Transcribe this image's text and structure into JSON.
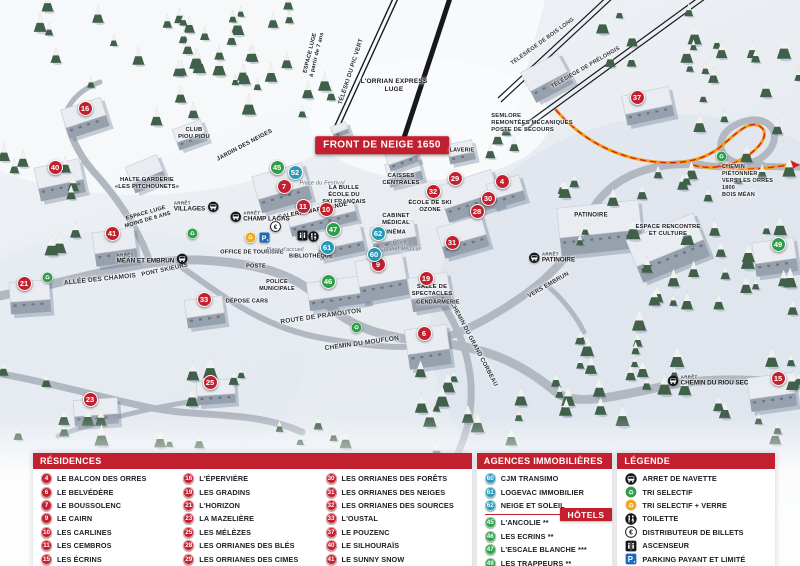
{
  "map": {
    "banner": "FRONT DE NEIGE 1650",
    "colors": {
      "residence": "#c2202e",
      "agency": "#2898b4",
      "hotel": "#2f9e49",
      "accent_red": "#c2202e",
      "path_orange": "#f39c12",
      "parking_blue": "#1a6ab5"
    },
    "markers": [
      {
        "n": "16",
        "type": "residence",
        "x": 85,
        "y": 108
      },
      {
        "n": "40",
        "type": "residence",
        "x": 55,
        "y": 167
      },
      {
        "n": "41",
        "type": "residence",
        "x": 112,
        "y": 233
      },
      {
        "n": "21",
        "type": "residence",
        "x": 24,
        "y": 283
      },
      {
        "n": "33",
        "type": "residence",
        "x": 204,
        "y": 299
      },
      {
        "n": "23",
        "type": "residence",
        "x": 90,
        "y": 399
      },
      {
        "n": "25",
        "type": "residence",
        "x": 210,
        "y": 382
      },
      {
        "n": "7",
        "type": "residence",
        "x": 284,
        "y": 186
      },
      {
        "n": "11",
        "type": "residence",
        "x": 303,
        "y": 206
      },
      {
        "n": "10",
        "type": "residence",
        "x": 326,
        "y": 209
      },
      {
        "n": "9",
        "type": "residence",
        "x": 378,
        "y": 264
      },
      {
        "n": "19",
        "type": "residence",
        "x": 426,
        "y": 278
      },
      {
        "n": "6",
        "type": "residence",
        "x": 424,
        "y": 333
      },
      {
        "n": "29",
        "type": "residence",
        "x": 455,
        "y": 178
      },
      {
        "n": "32",
        "type": "residence",
        "x": 433,
        "y": 191
      },
      {
        "n": "30",
        "type": "residence",
        "x": 488,
        "y": 198
      },
      {
        "n": "28",
        "type": "residence",
        "x": 477,
        "y": 211
      },
      {
        "n": "31",
        "type": "residence",
        "x": 452,
        "y": 242
      },
      {
        "n": "37",
        "type": "residence",
        "x": 637,
        "y": 97
      },
      {
        "n": "15",
        "type": "residence",
        "x": 778,
        "y": 378
      },
      {
        "n": "4",
        "type": "residence",
        "x": 502,
        "y": 181
      },
      {
        "n": "52",
        "type": "agency",
        "x": 295,
        "y": 172
      },
      {
        "n": "60",
        "type": "agency",
        "x": 374,
        "y": 254
      },
      {
        "n": "61",
        "type": "agency",
        "x": 327,
        "y": 247
      },
      {
        "n": "62",
        "type": "agency",
        "x": 378,
        "y": 233
      },
      {
        "n": "45",
        "type": "hotel",
        "x": 277,
        "y": 167
      },
      {
        "n": "47",
        "type": "hotel",
        "x": 333,
        "y": 229
      },
      {
        "n": "46",
        "type": "hotel",
        "x": 328,
        "y": 281
      },
      {
        "n": "49",
        "type": "hotel",
        "x": 778,
        "y": 244
      }
    ],
    "icons": [
      {
        "icon": "recycle-green",
        "x": 192,
        "y": 233
      },
      {
        "icon": "recycle-green",
        "x": 47,
        "y": 277
      },
      {
        "icon": "recycle-green",
        "x": 356,
        "y": 327
      },
      {
        "icon": "recycle-green",
        "x": 721,
        "y": 156
      },
      {
        "icon": "recycle-yellow",
        "x": 250,
        "y": 237
      },
      {
        "icon": "parking",
        "x": 264,
        "y": 237
      },
      {
        "icon": "euro",
        "x": 275,
        "y": 226
      },
      {
        "icon": "elevator",
        "x": 302,
        "y": 235
      },
      {
        "icon": "toilet",
        "x": 313,
        "y": 236
      }
    ],
    "stops": [
      {
        "prefix": "ARRÊT",
        "name": "VILLAGES",
        "x": 196,
        "y": 207,
        "side": "right"
      },
      {
        "prefix": "ARRÊT",
        "name": "CHAMP LACAS",
        "x": 260,
        "y": 217,
        "side": "left"
      },
      {
        "prefix": "ARRÊT",
        "name": "MÉAN ET EMBRUN",
        "x": 152,
        "y": 259,
        "side": "right"
      },
      {
        "prefix": "ARRÊT",
        "name": "PATINOIRE",
        "x": 552,
        "y": 258,
        "side": "left"
      },
      {
        "prefix": "ARRÊT",
        "name": "CHEMIN DU RIOU SEC",
        "x": 708,
        "y": 381,
        "side": "left"
      }
    ],
    "labels": [
      {
        "text": "FRONT DE NEIGE 1650",
        "x": 382,
        "y": 145,
        "style": "banner",
        "size": 10
      },
      {
        "text": "L'ORRIAN EXPRESS\nLUGE",
        "x": 394,
        "y": 86,
        "style": "poi",
        "size": 6.5
      },
      {
        "text": "TÉLÉSKI DU PIC VERT",
        "x": 352,
        "y": 72,
        "rot": -72,
        "style": "road",
        "size": 6
      },
      {
        "text": "ESPACE LUGE\nà partir de 7 ans",
        "x": 314,
        "y": 54,
        "rot": -76,
        "style": "poi",
        "size": 5.5
      },
      {
        "text": "TÉLÉSIÈGE DE BOIS LONG",
        "x": 543,
        "y": 42,
        "rot": -36,
        "style": "road",
        "size": 5.5
      },
      {
        "text": "TÉLÉSIÈGE DE PRÉLONGIS",
        "x": 586,
        "y": 68,
        "rot": -30,
        "style": "road",
        "size": 5.5
      },
      {
        "text": "SEMLORE\nREMONTÉES MÉCANIQUES\nPOSTE DE SECOURS",
        "x": 532,
        "y": 124,
        "style": "poi-left",
        "size": 5.8
      },
      {
        "text": "CLUB\nPIOU PIOU",
        "x": 194,
        "y": 134,
        "style": "poi",
        "size": 5.8
      },
      {
        "text": "JARDIN DES NEIGES",
        "x": 245,
        "y": 146,
        "rot": -28,
        "style": "poi",
        "size": 5.8
      },
      {
        "text": "HALTE GARDERIE\n«LES PITCHOUNETS»",
        "x": 147,
        "y": 184,
        "style": "poi",
        "size": 5.8
      },
      {
        "text": "ESPACE LUGE\nMOINS DE 6 ANS",
        "x": 147,
        "y": 217,
        "rot": -16,
        "style": "poi",
        "size": 5.5
      },
      {
        "text": "PONT SKIEURS",
        "x": 165,
        "y": 271,
        "rot": -12,
        "style": "road",
        "size": 6
      },
      {
        "text": "ALLÉE DES CHAMOIS",
        "x": 100,
        "y": 280,
        "rot": -6,
        "style": "road",
        "size": 6.5
      },
      {
        "text": "Place du Festival",
        "x": 322,
        "y": 184,
        "style": "place",
        "size": 5.5
      },
      {
        "text": "LA BULLE\nÉCOLE DU\nSKI FRANÇAIS",
        "x": 344,
        "y": 196,
        "style": "poi",
        "size": 5.8
      },
      {
        "text": "GALERIE MARCHANDE",
        "x": 313,
        "y": 212,
        "rot": -11,
        "style": "poi",
        "size": 6
      },
      {
        "text": "CAISSES\nCENTRALES",
        "x": 401,
        "y": 180,
        "style": "poi",
        "size": 5.8
      },
      {
        "text": "LAVERIE",
        "x": 462,
        "y": 151,
        "style": "poi",
        "size": 5.5
      },
      {
        "text": "CABINET\nMÉDICAL",
        "x": 396,
        "y": 220,
        "style": "poi",
        "size": 5.8
      },
      {
        "text": "CINÉMA",
        "x": 394,
        "y": 233,
        "style": "poi",
        "size": 5.8
      },
      {
        "text": "Place\nCabinet Médical",
        "x": 400,
        "y": 246,
        "style": "place",
        "size": 5.2
      },
      {
        "text": "ÉCOLE DE SKI\nOZONE",
        "x": 430,
        "y": 207,
        "style": "poi",
        "size": 5.8
      },
      {
        "text": "OFFICE DE TOURISME",
        "x": 252,
        "y": 253,
        "style": "poi",
        "size": 5.5
      },
      {
        "text": "POSTE",
        "x": 256,
        "y": 267,
        "style": "poi",
        "size": 5.5
      },
      {
        "text": "BIBLIOTHÈQUE",
        "x": 311,
        "y": 257,
        "style": "poi",
        "size": 5.5
      },
      {
        "text": "Place d'accueil",
        "x": 285,
        "y": 250,
        "style": "place",
        "size": 5.2
      },
      {
        "text": "POLICE\nMUNICIPALE",
        "x": 277,
        "y": 286,
        "style": "poi",
        "size": 5.5
      },
      {
        "text": "DÉPOSE CARS",
        "x": 247,
        "y": 302,
        "style": "poi",
        "size": 5.5
      },
      {
        "text": "ROUTE DE PRAMOUTON",
        "x": 321,
        "y": 317,
        "rot": -8,
        "style": "road",
        "size": 6.5
      },
      {
        "text": "CHEMIN DU MOUFLON",
        "x": 362,
        "y": 344,
        "rot": -8,
        "style": "road",
        "size": 6.5
      },
      {
        "text": "CHEMIN DU GRAND CORBEAU",
        "x": 473,
        "y": 345,
        "rot": 62,
        "style": "road",
        "size": 6
      },
      {
        "text": "SALLE DE\nSPECTACLES",
        "x": 432,
        "y": 291,
        "style": "poi",
        "size": 5.8
      },
      {
        "text": "GENDARMERIE",
        "x": 438,
        "y": 303,
        "style": "poi",
        "size": 5.5
      },
      {
        "text": "PATINOIRE",
        "x": 591,
        "y": 216,
        "style": "poi",
        "size": 6
      },
      {
        "text": "ESPACE RENCONTRE\nET CULTURE",
        "x": 668,
        "y": 231,
        "style": "poi",
        "size": 5.8
      },
      {
        "text": "VERS EMBRUN",
        "x": 549,
        "y": 286,
        "rot": -30,
        "style": "road",
        "size": 6
      },
      {
        "text": "CHEMIN PIÉTONNIER\nVERS LES ORRES 1800\nBOIS MÉAN",
        "x": 748,
        "y": 181,
        "style": "poi-left",
        "size": 5.5
      }
    ]
  },
  "legend": {
    "residences": {
      "title": "RÉSIDENCES",
      "columns": [
        [
          {
            "n": "4",
            "label": "LE BALCON DES ORRES"
          },
          {
            "n": "6",
            "label": "LE BELVÉDÈRE"
          },
          {
            "n": "7",
            "label": "LE BOUSSOLENC"
          },
          {
            "n": "9",
            "label": "LE CAIRN"
          },
          {
            "n": "10",
            "label": "LES CARLINES"
          },
          {
            "n": "11",
            "label": "LES CEMBROS"
          },
          {
            "n": "15",
            "label": "LES ÉCRINS"
          }
        ],
        [
          {
            "n": "16",
            "label": "L'ÉPERVIÈRE"
          },
          {
            "n": "19",
            "label": "LES GRADINS"
          },
          {
            "n": "21",
            "label": "L'HORIZON"
          },
          {
            "n": "23",
            "label": "LA MAZELIÈRE"
          },
          {
            "n": "25",
            "label": "LES MÉLÈZES"
          },
          {
            "n": "28",
            "label": "LES ORRIANES DES BLÉS"
          },
          {
            "n": "29",
            "label": "LES ORRIANES DES CIMES"
          }
        ],
        [
          {
            "n": "30",
            "label": "LES ORRIANES DES FORÊTS"
          },
          {
            "n": "31",
            "label": "LES ORRIANES DES NEIGES"
          },
          {
            "n": "32",
            "label": "LES ORRIANES DES SOURCES"
          },
          {
            "n": "33",
            "label": "L'OUSTAL"
          },
          {
            "n": "37",
            "label": "LE POUZENC"
          },
          {
            "n": "40",
            "label": "LE SILHOURAÏS"
          },
          {
            "n": "41",
            "label": "LE SUNNY SNOW"
          }
        ]
      ]
    },
    "agencies": {
      "title": "AGENCES IMMOBILIÈRES",
      "items": [
        {
          "n": "60",
          "label": "CJM TRANSIMO"
        },
        {
          "n": "61",
          "label": "LOGEVAC IMMOBILIER"
        },
        {
          "n": "62",
          "label": "NEIGE ET SOLEIL"
        }
      ]
    },
    "hotels": {
      "title": "HÔTELS",
      "items": [
        {
          "n": "45",
          "label": "L'ANCOLIE **"
        },
        {
          "n": "46",
          "label": "LES ECRINS **"
        },
        {
          "n": "47",
          "label": "L'ESCALE BLANCHE ***"
        },
        {
          "n": "49",
          "label": "LES TRAPPEURS **"
        }
      ]
    },
    "legende": {
      "title": "LÉGENDE",
      "items": [
        {
          "icon": "bus",
          "label": "ARRET DE NAVETTE"
        },
        {
          "icon": "recycle-green",
          "label": "TRI SELECTIF"
        },
        {
          "icon": "recycle-yellow",
          "label": "TRI SELECTIF + VERRE"
        },
        {
          "icon": "toilet",
          "label": "TOILETTE"
        },
        {
          "icon": "euro",
          "label": "DISTRIBUTEUR DE BILLETS"
        },
        {
          "icon": "elevator",
          "label": "ASCENSEUR"
        },
        {
          "icon": "parking",
          "label": "PARKING PAYANT ET LIMITÉ"
        }
      ]
    }
  }
}
